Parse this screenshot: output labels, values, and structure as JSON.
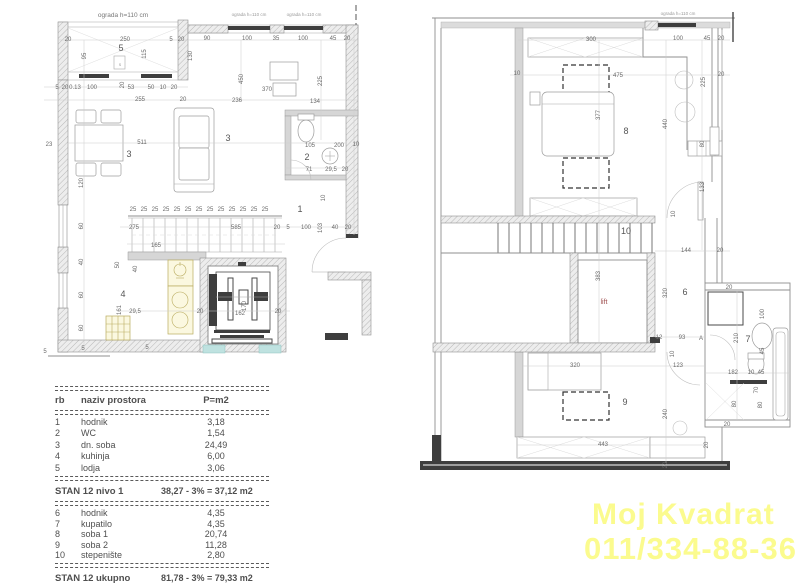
{
  "watermark": {
    "line1": "Moj Kvadrat",
    "line2": "011/334-88-36",
    "color": "#fbfb8e"
  },
  "colors": {
    "watermark_yellow": "#fbfb8e",
    "lift_label_red": "#a05252",
    "fixture_yellow": "#fbf8e0",
    "lift_pit_teal": "#bfe2e0",
    "wall_gray": "#d6d6d6"
  },
  "table": {
    "headers": {
      "rb": "rb",
      "name": "naziv prostora",
      "area": "P=m2"
    },
    "level1": [
      {
        "rb": "1",
        "name": "hodnik",
        "area": "3,18"
      },
      {
        "rb": "2",
        "name": "WC",
        "area": "1,54"
      },
      {
        "rb": "3",
        "name": "dn. soba",
        "area": "24,49"
      },
      {
        "rb": "4",
        "name": "kuhinja",
        "area": "6,00"
      },
      {
        "rb": "5",
        "name": "lodja",
        "area": "3,06"
      }
    ],
    "subtotal1": {
      "label": "STAN 12 nivo 1",
      "value": "38,27 - 3% = 37,12 m2"
    },
    "level2": [
      {
        "rb": "6",
        "name": "hodnik",
        "area": "4,35"
      },
      {
        "rb": "7",
        "name": "kupatilo",
        "area": "4,35"
      },
      {
        "rb": "8",
        "name": "soba 1",
        "area": "20,74"
      },
      {
        "rb": "9",
        "name": "soba 2",
        "area": "11,28"
      },
      {
        "rb": "10",
        "name": "stepenište",
        "area": "2,80"
      }
    ],
    "total": {
      "label": "STAN 12 ukupno",
      "value": "81,78 - 3% = 79,33 m2"
    }
  },
  "plans": {
    "left": {
      "labels": [
        {
          "t": "ograda h=110 cm",
          "x": 123,
          "y": 17,
          "c": "note"
        },
        {
          "t": "ograda h=110 cm",
          "x": 249,
          "y": 16,
          "c": "tiny"
        },
        {
          "t": "ograda h=110 cm",
          "x": 304,
          "y": 16,
          "c": "tiny"
        },
        {
          "t": "20",
          "x": 68,
          "y": 41
        },
        {
          "t": "250",
          "x": 125,
          "y": 41
        },
        {
          "t": "5",
          "x": 171,
          "y": 41
        },
        {
          "t": "20",
          "x": 181,
          "y": 41
        },
        {
          "t": "90",
          "x": 207,
          "y": 40
        },
        {
          "t": "100",
          "x": 247,
          "y": 40
        },
        {
          "t": "35",
          "x": 276,
          "y": 40
        },
        {
          "t": "100",
          "x": 303,
          "y": 40
        },
        {
          "t": "45",
          "x": 333,
          "y": 40
        },
        {
          "t": "20",
          "x": 347,
          "y": 40
        },
        {
          "t": "95",
          "x": 86,
          "y": 56,
          "r": 1
        },
        {
          "t": "115",
          "x": 146,
          "y": 54,
          "r": 1
        },
        {
          "t": "130",
          "x": 192,
          "y": 56,
          "r": 1
        },
        {
          "t": "20",
          "x": 124,
          "y": 85,
          "r": 1
        },
        {
          "t": "5",
          "x": 121,
          "y": 51,
          "c": "room"
        },
        {
          "t": "s",
          "x": 120,
          "y": 66,
          "c": "tiny"
        },
        {
          "t": "5",
          "x": 57,
          "y": 89
        },
        {
          "t": "20",
          "x": 65,
          "y": 89
        },
        {
          "t": "0.13",
          "x": 75,
          "y": 89
        },
        {
          "t": "100",
          "x": 92,
          "y": 89
        },
        {
          "t": "53",
          "x": 131,
          "y": 89
        },
        {
          "t": "50",
          "x": 151,
          "y": 89
        },
        {
          "t": "10",
          "x": 163,
          "y": 89
        },
        {
          "t": "20",
          "x": 174,
          "y": 89
        },
        {
          "t": "255",
          "x": 140,
          "y": 101
        },
        {
          "t": "20",
          "x": 183,
          "y": 101
        },
        {
          "t": "236",
          "x": 237,
          "y": 102
        },
        {
          "t": "370",
          "x": 267,
          "y": 91
        },
        {
          "t": "134",
          "x": 315,
          "y": 103
        },
        {
          "t": "450",
          "x": 243,
          "y": 79,
          "r": 1
        },
        {
          "t": "225",
          "x": 322,
          "y": 81,
          "r": 1
        },
        {
          "t": "511",
          "x": 142,
          "y": 144
        },
        {
          "t": "3",
          "x": 129,
          "y": 157,
          "c": "room"
        },
        {
          "t": "3",
          "x": 228,
          "y": 141,
          "c": "room"
        },
        {
          "t": "105",
          "x": 310,
          "y": 147
        },
        {
          "t": "200",
          "x": 339,
          "y": 147
        },
        {
          "t": "10",
          "x": 356,
          "y": 146
        },
        {
          "t": "2",
          "x": 307,
          "y": 160,
          "c": "room"
        },
        {
          "t": "71",
          "x": 309,
          "y": 171
        },
        {
          "t": "29,5",
          "x": 331,
          "y": 171
        },
        {
          "t": "20",
          "x": 345,
          "y": 171
        },
        {
          "t": "1",
          "x": 300,
          "y": 212,
          "c": "room"
        },
        {
          "t": "23",
          "x": 49,
          "y": 146
        },
        {
          "t": "120",
          "x": 83,
          "y": 183,
          "r": 1
        },
        {
          "t": "60",
          "x": 83,
          "y": 226,
          "r": 1
        },
        {
          "t": "40",
          "x": 83,
          "y": 262,
          "r": 1
        },
        {
          "t": "60",
          "x": 83,
          "y": 295,
          "r": 1
        },
        {
          "t": "60",
          "x": 83,
          "y": 328,
          "r": 1
        },
        {
          "t": "25",
          "x": 133,
          "y": 211
        },
        {
          "t": "25",
          "x": 144,
          "y": 211
        },
        {
          "t": "25",
          "x": 155,
          "y": 211
        },
        {
          "t": "25",
          "x": 166,
          "y": 211
        },
        {
          "t": "25",
          "x": 177,
          "y": 211
        },
        {
          "t": "25",
          "x": 188,
          "y": 211
        },
        {
          "t": "25",
          "x": 199,
          "y": 211
        },
        {
          "t": "25",
          "x": 210,
          "y": 211
        },
        {
          "t": "25",
          "x": 221,
          "y": 211
        },
        {
          "t": "25",
          "x": 232,
          "y": 211
        },
        {
          "t": "25",
          "x": 243,
          "y": 211
        },
        {
          "t": "25",
          "x": 254,
          "y": 211
        },
        {
          "t": "25",
          "x": 265,
          "y": 211
        },
        {
          "t": "275",
          "x": 134,
          "y": 229
        },
        {
          "t": "585",
          "x": 236,
          "y": 229
        },
        {
          "t": "20",
          "x": 277,
          "y": 229
        },
        {
          "t": "5",
          "x": 288,
          "y": 229
        },
        {
          "t": "100",
          "x": 306,
          "y": 229
        },
        {
          "t": "103",
          "x": 322,
          "y": 228,
          "r": 1
        },
        {
          "t": "40",
          "x": 335,
          "y": 229
        },
        {
          "t": "20",
          "x": 348,
          "y": 229
        },
        {
          "t": "10",
          "x": 325,
          "y": 198,
          "r": 1
        },
        {
          "t": "165",
          "x": 156,
          "y": 247
        },
        {
          "t": "50",
          "x": 119,
          "y": 265,
          "r": 1
        },
        {
          "t": "40",
          "x": 137,
          "y": 269,
          "r": 1
        },
        {
          "t": "4",
          "x": 123,
          "y": 297,
          "c": "room"
        },
        {
          "t": "161",
          "x": 121,
          "y": 310,
          "r": 1
        },
        {
          "t": "29,5",
          "x": 135,
          "y": 313
        },
        {
          "t": "20",
          "x": 200,
          "y": 313
        },
        {
          "t": "162",
          "x": 240,
          "y": 315
        },
        {
          "t": "170",
          "x": 246,
          "y": 306,
          "r": 1
        },
        {
          "t": "20",
          "x": 278,
          "y": 313
        },
        {
          "t": "5",
          "x": 45,
          "y": 353
        },
        {
          "t": "5",
          "x": 83,
          "y": 350
        },
        {
          "t": "5",
          "x": 147,
          "y": 349
        }
      ]
    },
    "right": {
      "labels": [
        {
          "t": "ograda h=110 cm",
          "x": 678,
          "y": 15,
          "c": "tiny"
        },
        {
          "t": "300",
          "x": 591,
          "y": 41
        },
        {
          "t": "100",
          "x": 678,
          "y": 40
        },
        {
          "t": "45",
          "x": 707,
          "y": 40
        },
        {
          "t": "20",
          "x": 721,
          "y": 40
        },
        {
          "t": "10",
          "x": 517,
          "y": 75
        },
        {
          "t": "475",
          "x": 618,
          "y": 77
        },
        {
          "t": "20",
          "x": 721,
          "y": 76
        },
        {
          "t": "225",
          "x": 705,
          "y": 82,
          "r": 1
        },
        {
          "t": "377",
          "x": 600,
          "y": 115,
          "r": 1
        },
        {
          "t": "440",
          "x": 667,
          "y": 124,
          "r": 1
        },
        {
          "t": "8",
          "x": 626,
          "y": 134,
          "c": "room"
        },
        {
          "t": "80",
          "x": 704,
          "y": 144,
          "r": 1
        },
        {
          "t": "133",
          "x": 704,
          "y": 187,
          "r": 1
        },
        {
          "t": "10",
          "x": 675,
          "y": 214,
          "r": 1
        },
        {
          "t": "10",
          "x": 626,
          "y": 234,
          "c": "room"
        },
        {
          "t": "144",
          "x": 686,
          "y": 252
        },
        {
          "t": "20",
          "x": 720,
          "y": 252
        },
        {
          "t": "383",
          "x": 600,
          "y": 276,
          "r": 1
        },
        {
          "t": "320",
          "x": 667,
          "y": 293,
          "r": 1
        },
        {
          "t": "6",
          "x": 685,
          "y": 295,
          "c": "room"
        },
        {
          "t": "lift",
          "x": 604,
          "y": 304,
          "c": "red"
        },
        {
          "t": "12",
          "x": 659,
          "y": 339
        },
        {
          "t": "93",
          "x": 682,
          "y": 339
        },
        {
          "t": "A",
          "x": 701,
          "y": 340
        },
        {
          "t": "10",
          "x": 674,
          "y": 354,
          "r": 1
        },
        {
          "t": "320",
          "x": 575,
          "y": 367
        },
        {
          "t": "123",
          "x": 678,
          "y": 367
        },
        {
          "t": "20",
          "x": 729,
          "y": 289
        },
        {
          "t": "100",
          "x": 764,
          "y": 314,
          "r": 1
        },
        {
          "t": "210",
          "x": 738,
          "y": 338,
          "r": 1
        },
        {
          "t": "7",
          "x": 748,
          "y": 342,
          "c": "room"
        },
        {
          "t": "45",
          "x": 764,
          "y": 351,
          "r": 1
        },
        {
          "t": "182",
          "x": 733,
          "y": 374
        },
        {
          "t": "10",
          "x": 751,
          "y": 374
        },
        {
          "t": "45",
          "x": 761,
          "y": 374
        },
        {
          "t": "70",
          "x": 758,
          "y": 390,
          "r": 1
        },
        {
          "t": "80",
          "x": 736,
          "y": 404,
          "r": 1
        },
        {
          "t": "80",
          "x": 762,
          "y": 405,
          "r": 1
        },
        {
          "t": "20",
          "x": 727,
          "y": 426
        },
        {
          "t": "240",
          "x": 667,
          "y": 414,
          "r": 1
        },
        {
          "t": "9",
          "x": 625,
          "y": 405,
          "c": "room"
        },
        {
          "t": "443",
          "x": 603,
          "y": 446
        },
        {
          "t": "20",
          "x": 708,
          "y": 445,
          "r": 1
        },
        {
          "t": "20",
          "x": 667,
          "y": 465,
          "r": 1
        }
      ]
    }
  }
}
